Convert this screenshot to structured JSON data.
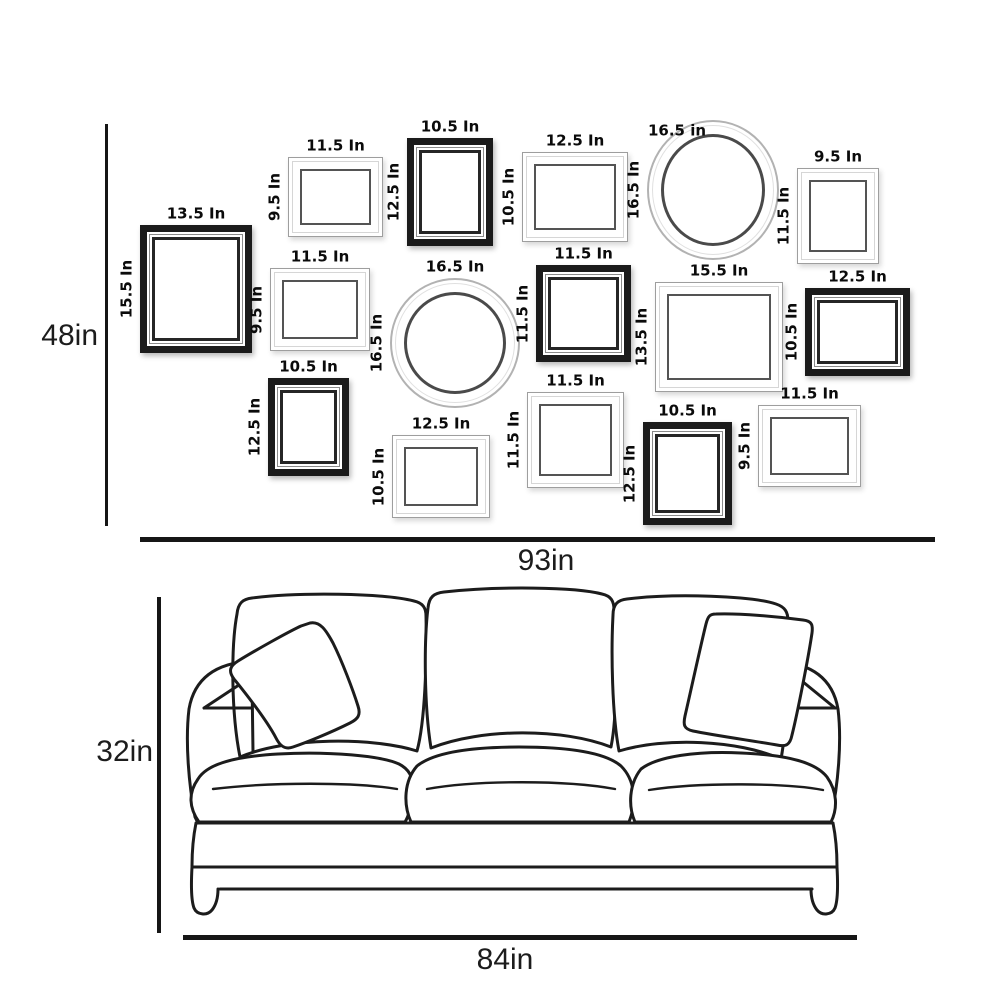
{
  "diagram": {
    "wall": {
      "height": {
        "label": "48in"
      },
      "width": {
        "label": "93in"
      },
      "frames": [
        {
          "name": "frame-1",
          "shape": "rect",
          "variant": "dark",
          "x": 140,
          "y": 225,
          "w": 112,
          "h": 128,
          "width_label": "13.5 In",
          "height_label": "15.5 In"
        },
        {
          "name": "frame-2",
          "shape": "rect",
          "variant": "light",
          "x": 288,
          "y": 157,
          "w": 95,
          "h": 80,
          "width_label": "11.5 In",
          "height_label": "9.5 In"
        },
        {
          "name": "frame-3",
          "shape": "rect",
          "variant": "dark",
          "x": 407,
          "y": 138,
          "w": 86,
          "h": 108,
          "width_label": "10.5 In",
          "height_label": "12.5 In"
        },
        {
          "name": "frame-4",
          "shape": "rect",
          "variant": "light",
          "x": 522,
          "y": 152,
          "w": 106,
          "h": 90,
          "width_label": "12.5 In",
          "height_label": "10.5 In"
        },
        {
          "name": "frame-5",
          "shape": "circle",
          "variant": "light",
          "x": 647,
          "y": 120,
          "w": 132,
          "h": 140,
          "width_label": "16.5 in",
          "height_label": "16.5 In",
          "label_dx": -36,
          "label_dy": 22
        },
        {
          "name": "frame-6",
          "shape": "rect",
          "variant": "light",
          "x": 797,
          "y": 168,
          "w": 82,
          "h": 96,
          "width_label": "9.5 In",
          "height_label": "11.5 In"
        },
        {
          "name": "frame-7",
          "shape": "rect",
          "variant": "light",
          "x": 270,
          "y": 268,
          "w": 100,
          "h": 83,
          "width_label": "11.5 In",
          "height_label": "9.5 In"
        },
        {
          "name": "frame-8",
          "shape": "circle",
          "variant": "light",
          "x": 390,
          "y": 278,
          "w": 130,
          "h": 130,
          "width_label": "16.5 In",
          "height_label": "16.5 In"
        },
        {
          "name": "frame-9",
          "shape": "rect",
          "variant": "dark",
          "x": 536,
          "y": 265,
          "w": 95,
          "h": 97,
          "width_label": "11.5 In",
          "height_label": "11.5 In"
        },
        {
          "name": "frame-10",
          "shape": "rect",
          "variant": "light",
          "x": 655,
          "y": 282,
          "w": 128,
          "h": 110,
          "width_label": "15.5 In",
          "height_label": "13.5 In"
        },
        {
          "name": "frame-11",
          "shape": "rect",
          "variant": "dark",
          "x": 805,
          "y": 288,
          "w": 105,
          "h": 88,
          "width_label": "12.5 In",
          "height_label": "10.5 In"
        },
        {
          "name": "frame-12",
          "shape": "rect",
          "variant": "dark",
          "x": 268,
          "y": 378,
          "w": 81,
          "h": 98,
          "width_label": "10.5 In",
          "height_label": "12.5 In"
        },
        {
          "name": "frame-13",
          "shape": "rect",
          "variant": "light",
          "x": 392,
          "y": 435,
          "w": 98,
          "h": 83,
          "width_label": "12.5 In",
          "height_label": "10.5 In"
        },
        {
          "name": "frame-14",
          "shape": "rect",
          "variant": "light",
          "x": 527,
          "y": 392,
          "w": 97,
          "h": 96,
          "width_label": "11.5 In",
          "height_label": "11.5 In"
        },
        {
          "name": "frame-15",
          "shape": "rect",
          "variant": "dark",
          "x": 643,
          "y": 422,
          "w": 89,
          "h": 103,
          "width_label": "10.5 In",
          "height_label": "12.5 In"
        },
        {
          "name": "frame-16",
          "shape": "rect",
          "variant": "light",
          "x": 758,
          "y": 405,
          "w": 103,
          "h": 82,
          "width_label": "11.5 In",
          "height_label": "9.5 In"
        }
      ]
    },
    "sofa": {
      "height": {
        "label": "32in"
      },
      "width": {
        "label": "84in"
      }
    },
    "colors": {
      "ink": "#1c1c1c",
      "frame_dark": "#1b1b1b",
      "frame_light_edge": "#9e9e9e",
      "frame_opening_line": "#545454",
      "background": "#ffffff"
    }
  }
}
